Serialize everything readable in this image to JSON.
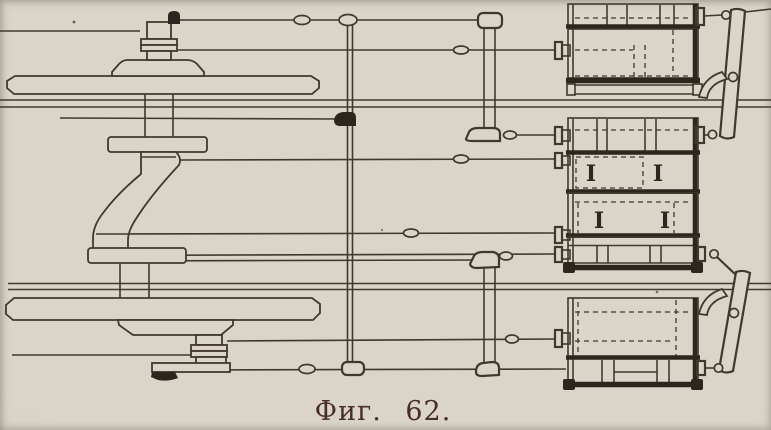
{
  "figure": {
    "caption": "Фиг. 62.",
    "beam_marks": [
      "I",
      "I",
      "I",
      "I"
    ]
  },
  "colors": {
    "paper": "#dad5c8",
    "paper_edge": "#ccc6b6",
    "ink": "#41382c",
    "ink_heavy": "#2c261e",
    "caption": "#4a2e23"
  }
}
